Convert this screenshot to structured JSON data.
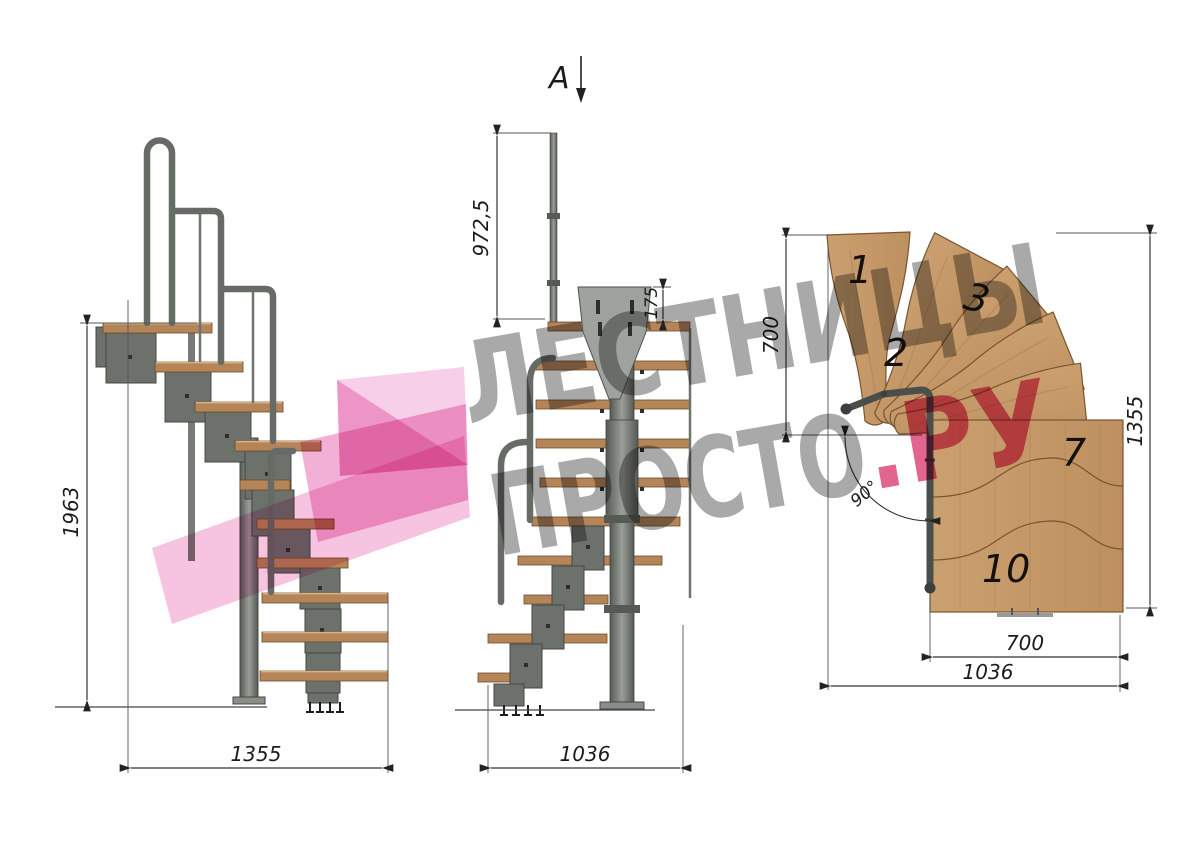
{
  "colors": {
    "wood_plan": "#c69a6b",
    "wood_side": "#b5855a",
    "metal": "#6b6f6a",
    "dimension_line": "#333333",
    "watermark_gray": "#969696",
    "watermark_pink": "#e0487c",
    "logo_pink": "#f6c3e0"
  },
  "watermark": {
    "line1": "ЛЕСТНИЦЫ",
    "line2": "ПРОСТО",
    "line2_accent": ".РУ"
  },
  "side_view": {
    "dim_height": "1963",
    "dim_length": "1355"
  },
  "front_view": {
    "section_label": "A",
    "dim_rail_height": "972,5",
    "dim_plate_height": "175",
    "dim_depth": "1036"
  },
  "plan_view": {
    "dim_rise_left": "700",
    "dim_height": "1355",
    "dim_width_inner": "700",
    "dim_width_total": "1036",
    "dim_angle": "90°",
    "steps": {
      "n1": "1",
      "n2": "2",
      "n3": "3",
      "n7": "7",
      "n10": "10"
    }
  }
}
